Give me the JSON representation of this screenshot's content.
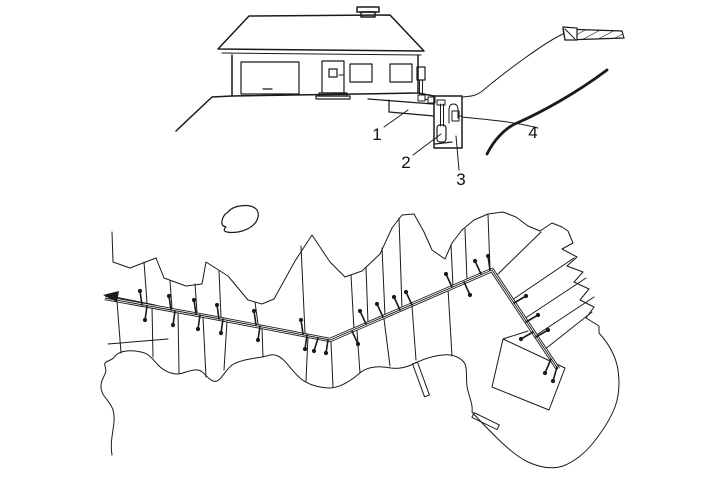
{
  "colors": {
    "ink": "#1a1a1a",
    "paper": "#ffffff"
  },
  "section": {
    "name": "house-and-pump-station-cross-section",
    "callouts": [
      {
        "label": "1",
        "target": "building-lateral-pipe"
      },
      {
        "label": "2",
        "target": "grinder-pump"
      },
      {
        "label": "3",
        "target": "pump-chamber"
      },
      {
        "label": "4",
        "target": "street-pressure-main"
      }
    ]
  },
  "plan": {
    "name": "shoreline-subdivision-site-plan",
    "flow_arrow_direction": "left",
    "main_points": "105,298 210,317 330,340 492,270 558,369",
    "service_connections": [
      [
        142,
        305,
        140,
        291
      ],
      [
        147,
        306,
        145,
        320
      ],
      [
        171,
        310,
        169,
        296
      ],
      [
        175,
        311,
        173,
        325
      ],
      [
        196,
        314,
        194,
        300
      ],
      [
        200,
        315,
        198,
        329
      ],
      [
        219,
        319,
        217,
        305
      ],
      [
        223,
        319,
        221,
        333
      ],
      [
        256,
        325,
        254,
        311
      ],
      [
        260,
        326,
        258,
        340
      ],
      [
        303,
        334,
        301,
        320
      ],
      [
        307,
        335,
        305,
        349
      ],
      [
        318,
        338,
        314,
        351
      ],
      [
        328,
        340,
        326,
        353
      ],
      [
        352,
        331,
        358,
        344
      ],
      [
        366,
        324,
        360,
        311
      ],
      [
        383,
        317,
        377,
        304
      ],
      [
        400,
        310,
        394,
        297
      ],
      [
        412,
        305,
        406,
        292
      ],
      [
        452,
        287,
        446,
        274
      ],
      [
        464,
        282,
        470,
        295
      ],
      [
        481,
        274,
        475,
        261
      ],
      [
        490,
        270,
        488,
        256
      ],
      [
        514,
        303,
        526,
        296
      ],
      [
        526,
        322,
        538,
        315
      ],
      [
        536,
        337,
        548,
        330
      ],
      [
        533,
        332,
        521,
        339
      ],
      [
        551,
        359,
        545,
        373
      ],
      [
        557,
        367,
        553,
        381
      ]
    ]
  }
}
